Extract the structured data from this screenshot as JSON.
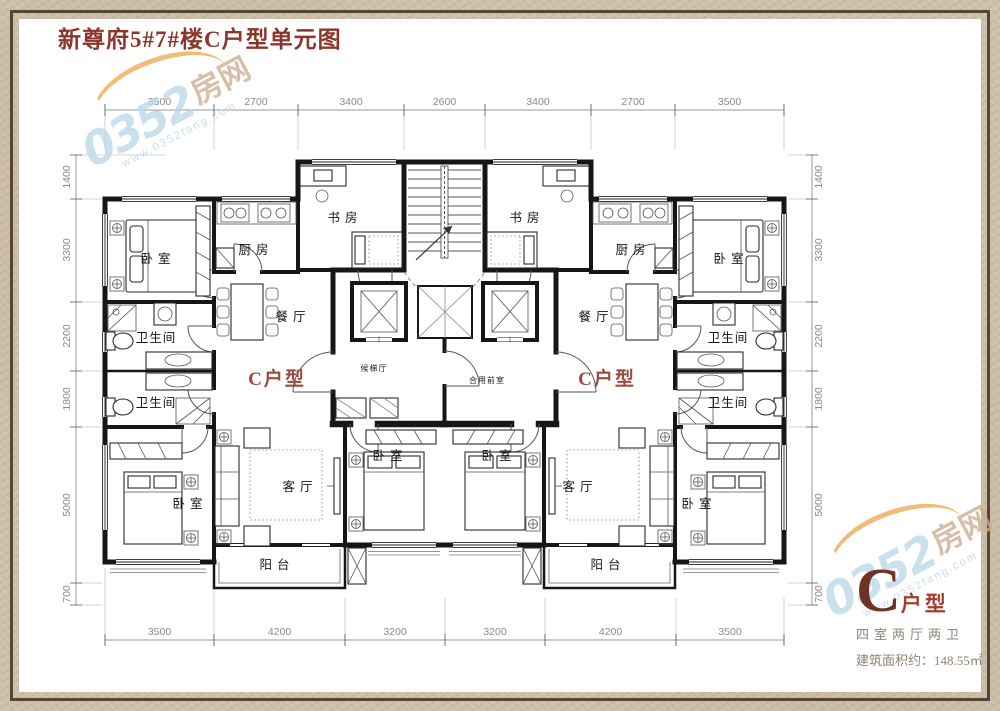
{
  "title": "新尊府5#7#楼C户型单元图",
  "watermark": {
    "brand_number": "0352",
    "brand_name": "房网",
    "url": "www.0352fang.com"
  },
  "legend": {
    "unit_letter": "C",
    "unit_type_suffix": "户型",
    "rooms_summary": "四室两厅两卫",
    "area_text": "建筑面积约：148.55㎡"
  },
  "plan": {
    "unit_label": "C户型",
    "room_labels": {
      "bedroom": "卧室",
      "study": "书房",
      "kitchen": "厨房",
      "dining": "餐厅",
      "bathroom": "卫生间",
      "living": "客厅",
      "balcony": "阳台",
      "elevator_hall": "候梯厅",
      "shared_vestibule": "合用前室"
    }
  },
  "dimensions": {
    "top": [
      "3500",
      "2700",
      "3400",
      "2600",
      "3400",
      "2700",
      "3500"
    ],
    "bottom": [
      "3500",
      "4200",
      "3200",
      "3200",
      "4200",
      "3500"
    ],
    "left": [
      "1400",
      "3300",
      "2200",
      "1800",
      "5000",
      "700"
    ],
    "right": [
      "1400",
      "3300",
      "2200",
      "1800",
      "5000",
      "700"
    ]
  }
}
